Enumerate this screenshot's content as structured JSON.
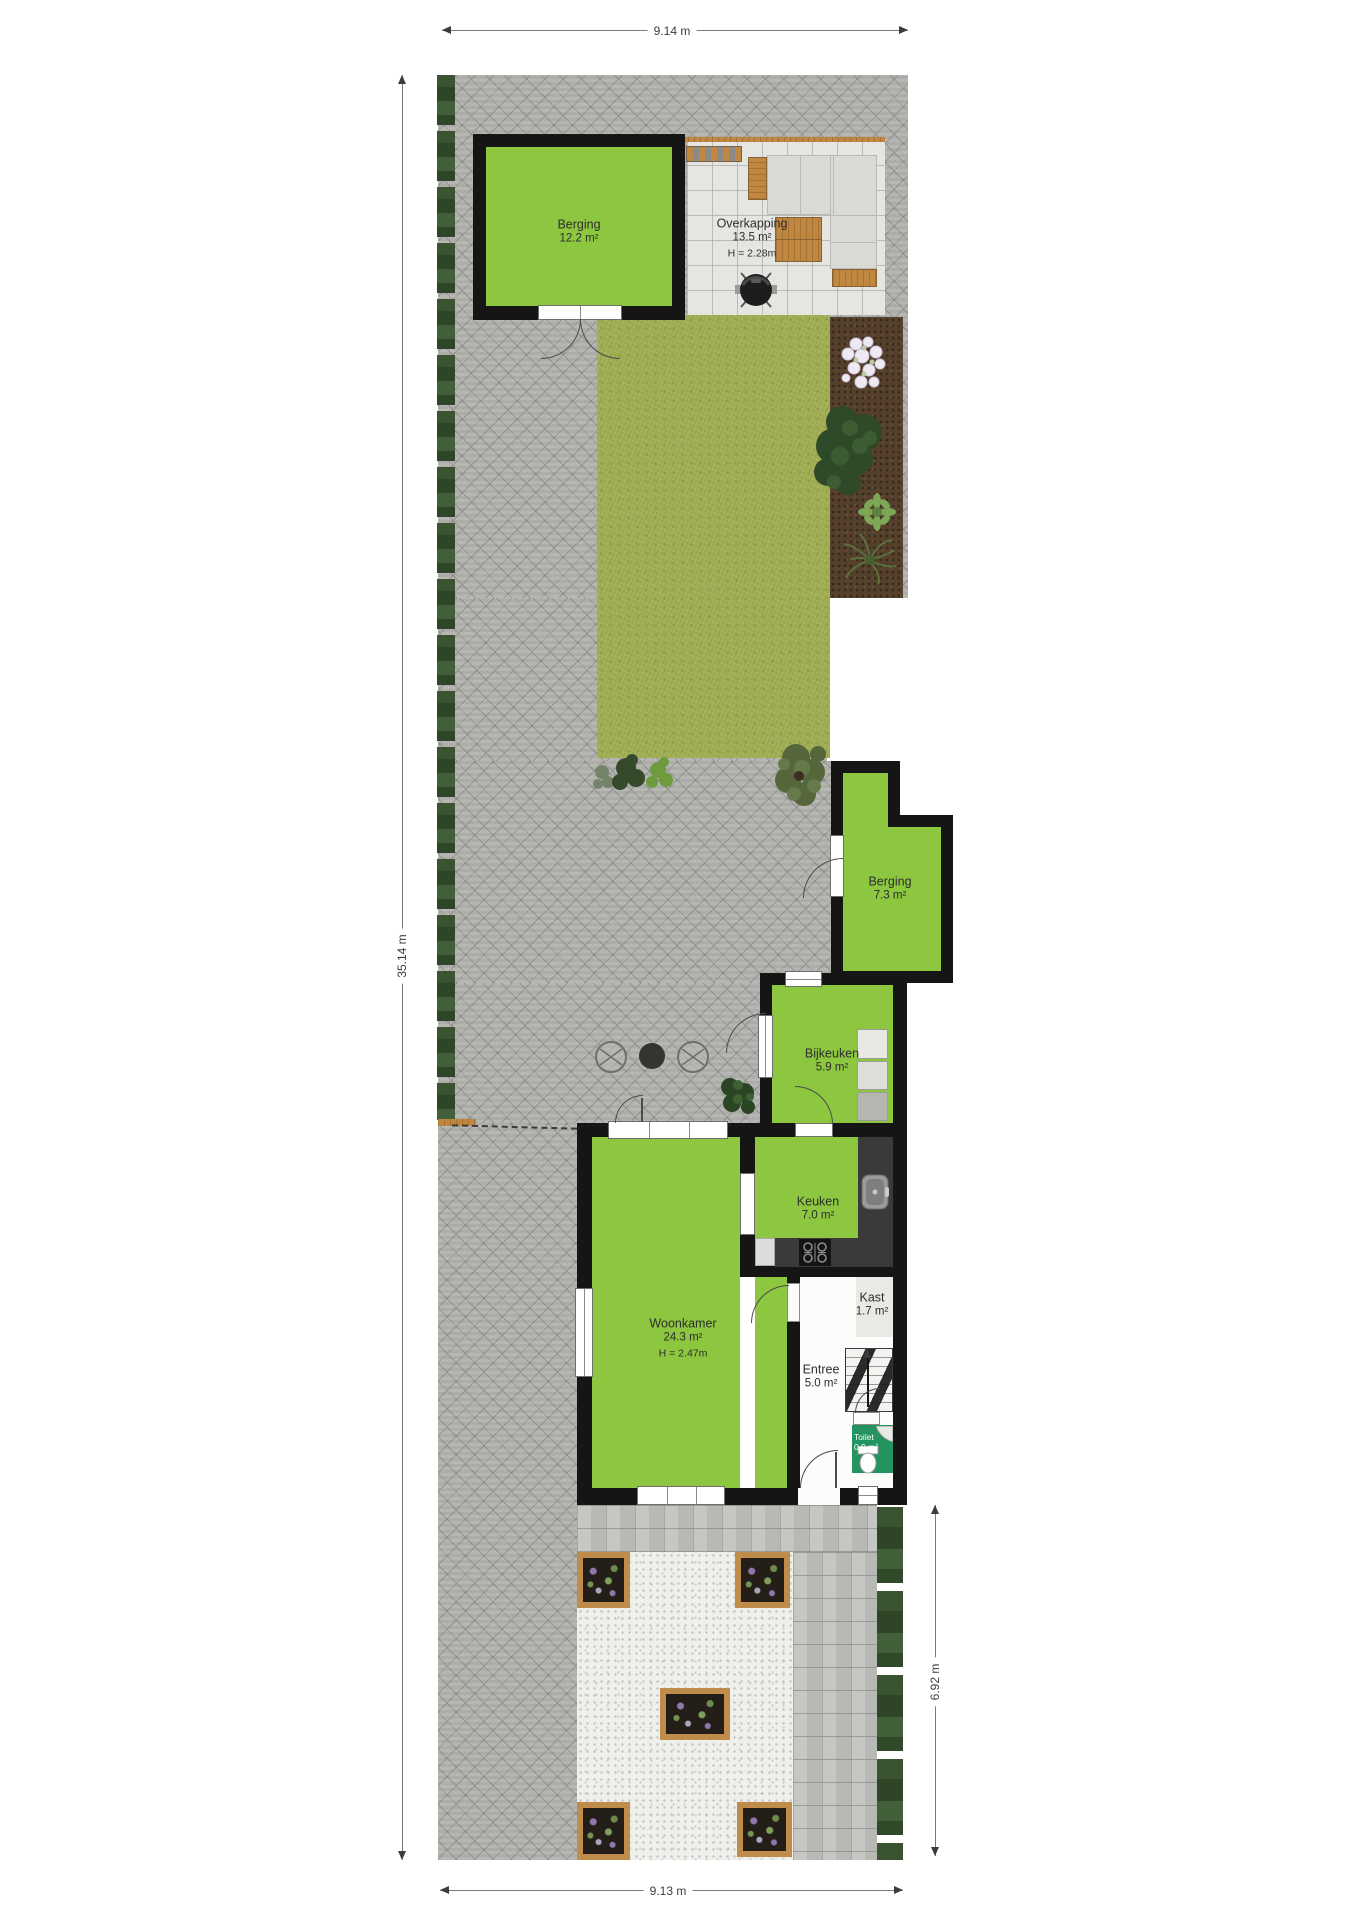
{
  "plan": {
    "type": "site-floorplan",
    "rooms": {
      "berging_top": {
        "name": "Berging",
        "area": "12.2 m²"
      },
      "overkapping": {
        "name": "Overkapping",
        "area": "13.5 m²",
        "height": "H = 2.28m"
      },
      "berging_mid": {
        "name": "Berging",
        "area": "7.3 m²"
      },
      "bijkeuken": {
        "name": "Bijkeuken",
        "area": "5.9 m²"
      },
      "keuken": {
        "name": "Keuken",
        "area": "7.0 m²"
      },
      "woonkamer": {
        "name": "Woonkamer",
        "area": "24.3 m²",
        "height": "H = 2.47m"
      },
      "kast": {
        "name": "Kast",
        "area": "1.7 m²"
      },
      "entree": {
        "name": "Entree",
        "area": "5.0 m²"
      },
      "toilet": {
        "name": "Toilet",
        "area": "0.9 m²"
      }
    },
    "dimensions": {
      "top": "9.14 m",
      "left": "35.14 m",
      "right": "6.92 m",
      "bottom": "9.13 m"
    },
    "garden_features": [
      "paved-herringbone-yard",
      "left-hedge",
      "lawn",
      "planting-bed-soil",
      "white-flowers",
      "shrubs",
      "olive-tree",
      "garden-lounge-set",
      "bbq-grill",
      "coffee-table",
      "round-garden-chairs",
      "front-gravel-garden",
      "wooden-planter-boxes",
      "right-hedge",
      "block-paved-path"
    ],
    "interior_features": [
      "washer-dryer-stack",
      "kitchen-counter",
      "sink",
      "stove",
      "staircase-up",
      "toilet-fixture",
      "corner-washbasin"
    ],
    "colors": {
      "room_green": "#8dc63f",
      "toilet_green": "#23935f",
      "wall": "#151515",
      "wood": "#c08740",
      "paving": "#b2b2af",
      "lawn": "#a1ae54",
      "soil": "#55402c",
      "hedge": "#35502f"
    }
  }
}
